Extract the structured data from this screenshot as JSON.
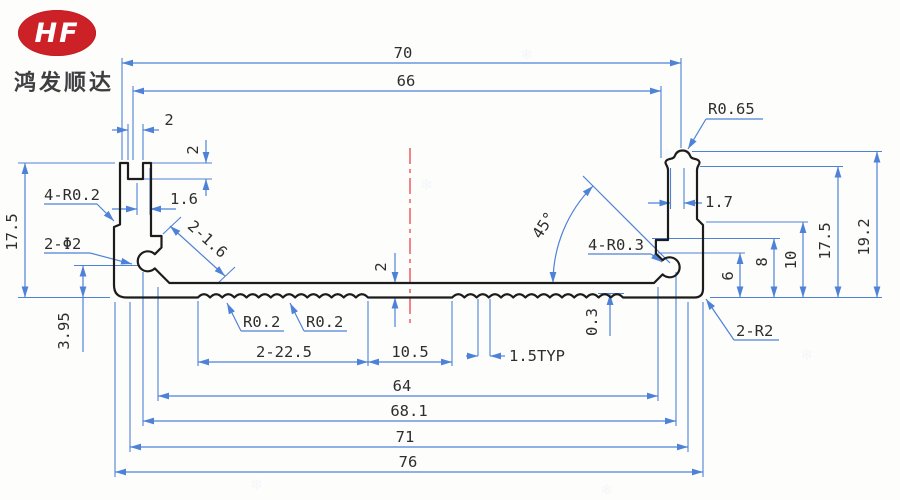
{
  "logo": {
    "hf": "HF",
    "company": "鸿发顺达",
    "brand_color": "#cc2127"
  },
  "drawing": {
    "dim_color": "#4e82d8",
    "outline_color": "#1c1c1c",
    "centerline_color": "#ee4f58",
    "dims": {
      "top_width": "70",
      "top_inner_width": "66",
      "slot_width": "2",
      "slot_depth": "2",
      "left_wall_thickness": "1.6",
      "left_corner_radius": "4-R0.2",
      "screw_holes": "2-Φ2",
      "left_height": "17.5",
      "hole_center_height": "3.95",
      "chamfer_width": "2-1.6",
      "serration_radius_1": "R0.2",
      "serration_radius_2": "R0.2",
      "serration_span": "2-22.5",
      "center_gap": "10.5",
      "serration_pitch": "1.5TYP",
      "floor_thickness": "2",
      "serration_depth": "0.3",
      "groove_angle": "45°",
      "groove_radius": "4-R0.3",
      "rib_tip_radius": "R0.65",
      "right_wall_thickness": "1.7",
      "height_6": "6",
      "height_8": "8",
      "height_10": "10",
      "right_height": "17.5",
      "total_height": "19.2",
      "bottom_corner_radius": "2-R2",
      "inner_width": "64",
      "width_68_1": "68.1",
      "width_71": "71",
      "width_76": "76"
    }
  }
}
